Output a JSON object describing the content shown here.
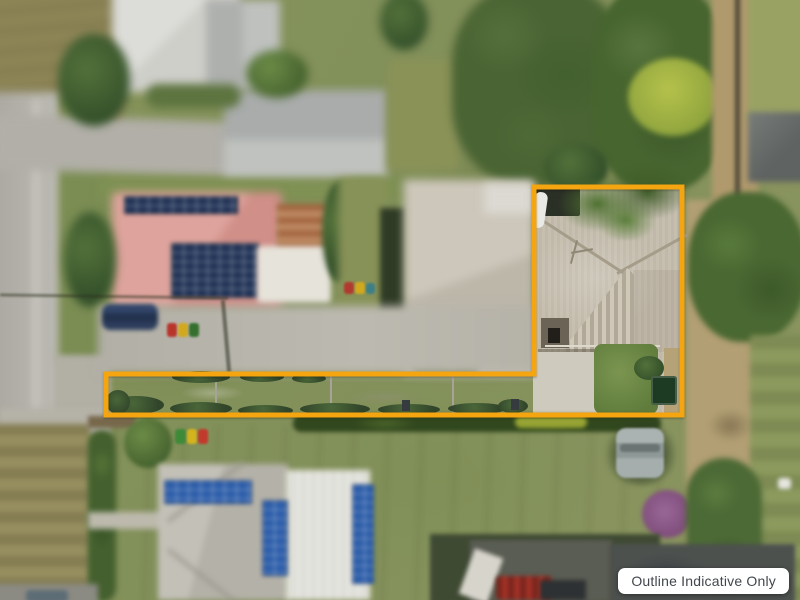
{
  "overlay": {
    "badge_label": "Outline Indicative Only",
    "badge_bg_color": "#ffffff",
    "badge_text_color": "#42474d"
  },
  "property_outline": {
    "color": "#f5a50f",
    "stroke_width": 5,
    "points": "534,187 682,187 682,415 106,415 106,374 534,374"
  }
}
